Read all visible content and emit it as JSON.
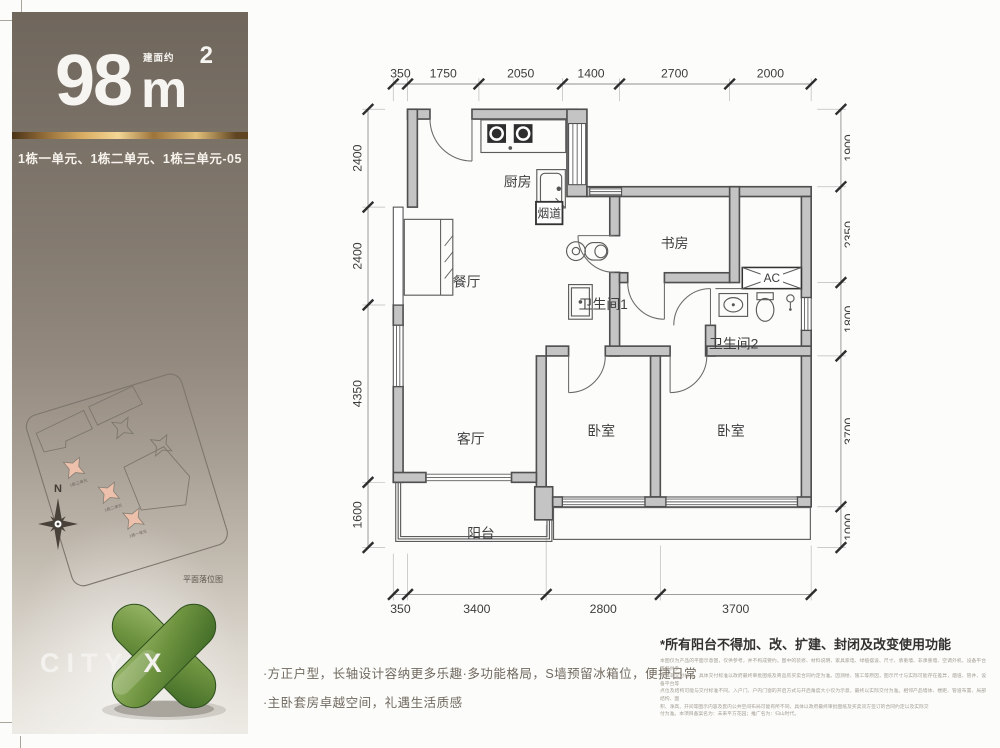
{
  "sidebar": {
    "area": {
      "value": "98",
      "unit": "m",
      "sup": "2",
      "prefix": "建面约"
    },
    "units_line": "1栋一单元、1栋二单元、1栋三单元-05",
    "site_plan": {
      "caption": "平面落位图",
      "compass": "N",
      "unit_labels": [
        "1栋三单元",
        "1栋二单元",
        "1栋一单元"
      ]
    },
    "logo": "CITY X",
    "colors": {
      "gold": "#d9ad62",
      "highlight": "#ecc0aa",
      "logo_green": "#5d8737"
    }
  },
  "floor_plan": {
    "rooms": {
      "kitchen": "厨房",
      "flue": "烟道",
      "dining": "餐厅",
      "study": "书房",
      "bath1": "卫生间1",
      "bath2": "卫生间2",
      "ac": "AC",
      "living": "客厅",
      "bedroom_mid": "卧室",
      "bedroom_right": "卧室",
      "balcony": "阳台"
    },
    "dims_top": [
      "350",
      "1750",
      "2050",
      "1400",
      "2700",
      "2000"
    ],
    "dims_bottom": [
      "350",
      "3400",
      "2800",
      "3700"
    ],
    "dims_left": [
      "2400",
      "2400",
      "4350",
      "1600"
    ],
    "dims_right": [
      "1900",
      "2350",
      "1800",
      "3700",
      "1000"
    ]
  },
  "notes": {
    "bullets": [
      "·方正户型，长轴设计容纳更多乐趣·多功能格局，S墙预留冰箱位，便捷日常",
      "·主卧套房卓越空间，礼遇生活质感"
    ]
  },
  "disclaimer": {
    "title": "*所有阳台不得加、改、扩建、封闭及改变使用功能",
    "lines": [
      "本图仅为产品的平面示意图，仅供参考，并不构成要约。图中的装修、材料说明、家具家电、绿植摆设、尺寸、承重墙、非承重墙、空调外机、设备平台等仅供参",
      "考，非交付标准。具体交付标准以政府最终审批图纸及商品房买卖合同约定为准。因测绘、施工等原因，图示尺寸与实际可能存在差异，烟道、管井、设备平台等",
      "点位及结构可能与交付标准不同。入户门、户内门窗的开启方式与开启角度大小仅为示意，最终以实际交付为准。相邻产品墙体、楼距、管道布置、局部结构、面",
      "积、净高、开间等图示内容及套内公共空间布局可能有所不同，具体以政府最终审批图纸及买卖双方签订的合同约定以及实际交",
      "付为准。本项目备案名为：未来平方花园；推广名为：归山时代。"
    ]
  }
}
